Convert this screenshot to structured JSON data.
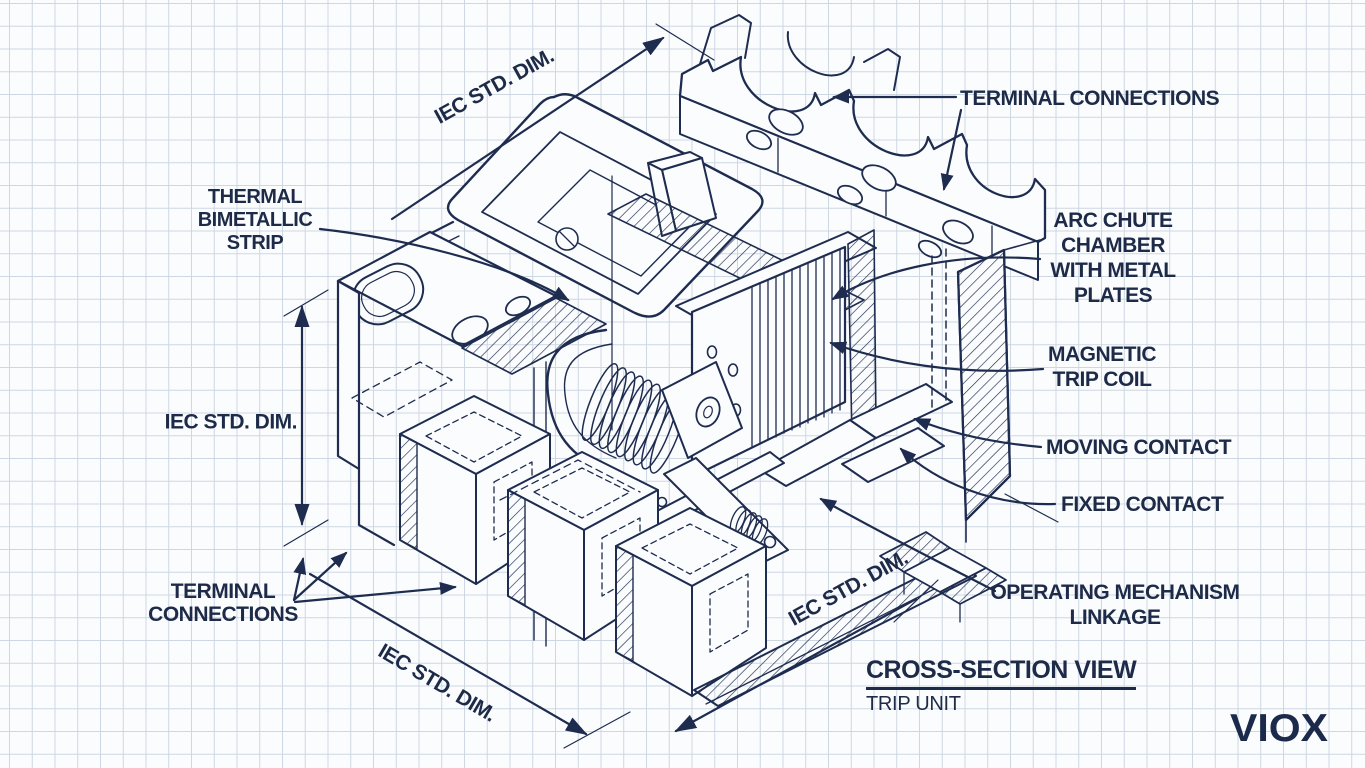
{
  "colors": {
    "ink": "#1e2c4f",
    "text": "#1d2b48",
    "grid": "#cdd7e2",
    "paper": "#fbfcfe",
    "logo": "#1b2a4a"
  },
  "labels": {
    "terminal_connections_top": "TERMINAL CONNECTIONS",
    "arc_chute": [
      "ARC CHUTE",
      "CHAMBER",
      "WITH METAL",
      "PLATES"
    ],
    "magnetic_trip_coil": [
      "MAGNETIC",
      "TRIP COIL"
    ],
    "moving_contact": "MOVING CONTACT",
    "fixed_contact": "FIXED CONTACT",
    "operating_mechanism_linkage": [
      "OPERATING MECHANISM",
      "LINKAGE"
    ],
    "thermal_bimetallic_strip": [
      "THERMAL",
      "BIMETALLIC",
      "STRIP"
    ],
    "terminal_connections_bottom": [
      "TERMINAL",
      "CONNECTIONS"
    ],
    "iec_std_dim": "IEC STD. DIM."
  },
  "title": {
    "heading": "CROSS-SECTION VIEW",
    "subheading": "TRIP UNIT"
  },
  "brand": {
    "logo_text": "VIOX"
  }
}
